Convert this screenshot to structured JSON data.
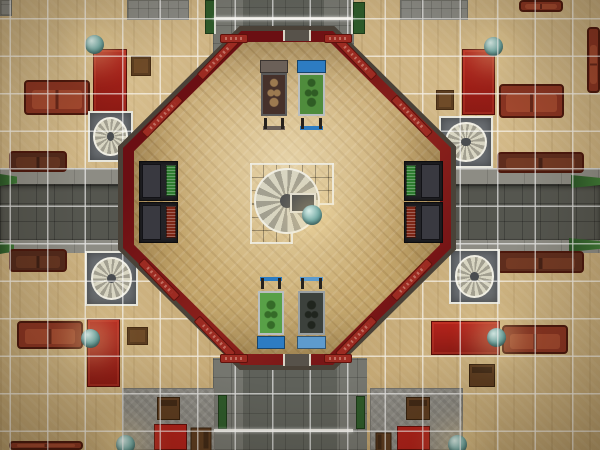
{
  "scene": {
    "view": "top-down-floorplan",
    "environment": "octagonal game room surrounded by tiled plaza with streets",
    "grid_spacing_px": 37.5,
    "colors": {
      "plaza_tile_tan": "#c9ae7d",
      "grid_line": "#ffffff",
      "street_dark": "#55564f",
      "sidewalk_gray": "#8d8c84",
      "wall_red": "#7a1216",
      "wall_panel_red": "#9c2b22",
      "roof_edge_brown": "#4a4238",
      "parquet_floor": "#cfb27c",
      "platform_slate": "#43474b",
      "railing_white": "#f0eee2",
      "sofa_red": "#8a3422",
      "sofa_dark_brown": "#5f2d1d",
      "bookcase_red": "#a8201a",
      "lamp_globe_teal": "#74aba5",
      "pinball_blue": "#2d7cc2",
      "pinball_green": "#4f8c3c",
      "planter_green": "#2e5a2a"
    }
  },
  "objects": [
    {
      "type": "concrete-patch",
      "name": "concrete-corner-northwest",
      "layer": "ext",
      "interactable": false,
      "x": 0,
      "y": 0,
      "w": 12,
      "h": 16
    },
    {
      "type": "concrete-patch",
      "name": "concrete-patch-north-left",
      "layer": "ext",
      "interactable": false,
      "x": 127,
      "y": 0,
      "w": 62,
      "h": 20
    },
    {
      "type": "concrete-patch",
      "name": "concrete-patch-north-right",
      "layer": "ext",
      "interactable": false,
      "x": 400,
      "y": 0,
      "w": 68,
      "h": 20
    },
    {
      "type": "patio",
      "name": "stone-patio-southwest",
      "layer": "ext",
      "interactable": false,
      "x": 122,
      "y": 388,
      "w": 93,
      "h": 62
    },
    {
      "type": "patio",
      "name": "stone-patio-southeast",
      "layer": "ext",
      "interactable": false,
      "x": 370,
      "y": 388,
      "w": 93,
      "h": 62
    },
    {
      "type": "green-wedge",
      "name": "hedge-west-upper",
      "layer": "ext",
      "x": 0,
      "y": 174,
      "w": 17,
      "h": 12
    },
    {
      "type": "green-wedge",
      "name": "hedge-west-lower",
      "layer": "ext",
      "x": 0,
      "y": 242,
      "w": 14,
      "h": 12
    },
    {
      "type": "green-wedge",
      "name": "hedge-east-upper",
      "layer": "ext",
      "x": 571,
      "y": 175,
      "w": 29,
      "h": 13
    },
    {
      "type": "green-wedge",
      "name": "hedge-east-lower",
      "layer": "ext",
      "x": 569,
      "y": 238,
      "w": 31,
      "h": 14
    },
    {
      "type": "planter",
      "name": "planter-north-left",
      "layer": "ext",
      "x": 205,
      "y": 0,
      "w": 11,
      "h": 34
    },
    {
      "type": "planter",
      "name": "planter-north-right",
      "layer": "ext",
      "x": 353,
      "y": 2,
      "w": 12,
      "h": 32
    },
    {
      "type": "planter",
      "name": "planter-south-left",
      "layer": "ext",
      "x": 218,
      "y": 395,
      "w": 9,
      "h": 34
    },
    {
      "type": "planter",
      "name": "planter-south-right",
      "layer": "ext",
      "x": 356,
      "y": 396,
      "w": 9,
      "h": 33
    },
    {
      "type": "path-rail",
      "name": "fence-north-left",
      "layer": "ext",
      "interactable": false,
      "x": 214,
      "y": 0,
      "w": 2,
      "h": 34
    },
    {
      "type": "path-rail",
      "name": "fence-north-right",
      "layer": "ext",
      "interactable": false,
      "x": 351,
      "y": 0,
      "w": 2,
      "h": 34
    },
    {
      "type": "couch",
      "name": "sofa-west-upper",
      "layer": "ext",
      "x": 9,
      "y": 151,
      "w": 58,
      "h": 21,
      "vars": {
        "--cc": "#52291b",
        "--cs": "#653521"
      }
    },
    {
      "type": "couch",
      "name": "sofa-west-lower",
      "layer": "ext",
      "x": 9,
      "y": 249,
      "w": 58,
      "h": 23,
      "vars": {
        "--cc": "#52291b",
        "--cs": "#653521"
      }
    },
    {
      "type": "couch",
      "name": "sofa-east-upper",
      "layer": "ext",
      "x": 497,
      "y": 152,
      "w": 87,
      "h": 21,
      "vars": {
        "--cc": "#5f2d1d",
        "--cs": "#743a24"
      }
    },
    {
      "type": "couch",
      "name": "sofa-east-lower",
      "layer": "ext",
      "x": 497,
      "y": 251,
      "w": 87,
      "h": 22,
      "vars": {
        "--cc": "#5f2d1d",
        "--cs": "#743a24"
      }
    },
    {
      "type": "couch",
      "name": "sofa-northwest",
      "layer": "ext",
      "x": 24,
      "y": 80,
      "w": 66,
      "h": 35
    },
    {
      "type": "couch",
      "name": "sofa-northeast",
      "layer": "ext",
      "x": 499,
      "y": 84,
      "w": 65,
      "h": 34
    },
    {
      "type": "couch",
      "name": "sofa-southwest",
      "layer": "ext",
      "x": 17,
      "y": 321,
      "w": 66,
      "h": 28
    },
    {
      "type": "couch",
      "name": "sofa-southeast",
      "layer": "ext",
      "x": 502,
      "y": 325,
      "w": 66,
      "h": 29
    },
    {
      "type": "couch",
      "name": "sofa-north-edge",
      "layer": "ext",
      "x": 519,
      "y": 0,
      "w": 44,
      "h": 12
    },
    {
      "type": "couch",
      "name": "sofa-east-edge",
      "cls": "v",
      "layer": "ext",
      "x": 587,
      "y": 27,
      "w": 13,
      "h": 66
    },
    {
      "type": "couch",
      "name": "sofa-south-edge",
      "layer": "ext",
      "x": 9,
      "y": 441,
      "w": 74,
      "h": 9
    },
    {
      "type": "bookshelf",
      "name": "bookcase-northwest",
      "layer": "ext",
      "x": 93,
      "y": 49,
      "w": 34,
      "h": 64
    },
    {
      "type": "bookshelf",
      "name": "bookcase-northeast",
      "layer": "ext",
      "x": 462,
      "y": 49,
      "w": 33,
      "h": 66
    },
    {
      "type": "bookshelf",
      "name": "bookcase-southwest",
      "layer": "ext",
      "x": 87,
      "y": 319,
      "w": 33,
      "h": 68
    },
    {
      "type": "bookshelf",
      "name": "bookcase-southeast",
      "layer": "ext",
      "x": 431,
      "y": 321,
      "w": 69,
      "h": 34
    },
    {
      "type": "end-table",
      "name": "end-table-northwest",
      "layer": "ext",
      "x": 131,
      "y": 56,
      "w": 20,
      "h": 20
    },
    {
      "type": "end-table",
      "name": "end-table-northeast",
      "layer": "ext",
      "x": 436,
      "y": 90,
      "w": 18,
      "h": 20
    },
    {
      "type": "end-table",
      "name": "end-table-southwest",
      "layer": "ext",
      "x": 127,
      "y": 327,
      "w": 21,
      "h": 18
    },
    {
      "type": "chair",
      "name": "chair-southeast",
      "layer": "ext",
      "x": 469,
      "y": 364,
      "w": 26,
      "h": 23
    },
    {
      "type": "chair",
      "name": "patio-chair-southwest-a",
      "layer": "ext",
      "x": 157,
      "y": 397,
      "w": 23,
      "h": 23
    },
    {
      "type": "red-table",
      "name": "patio-table-southwest",
      "layer": "ext",
      "x": 154,
      "y": 424,
      "w": 33,
      "h": 26
    },
    {
      "type": "chair",
      "name": "patio-chair-southwest-b",
      "layer": "ext",
      "rot": 90,
      "x": 189,
      "y": 429,
      "w": 24,
      "h": 21
    },
    {
      "type": "chair",
      "name": "patio-chair-southeast-a",
      "layer": "ext",
      "x": 406,
      "y": 397,
      "w": 24,
      "h": 23
    },
    {
      "type": "red-table",
      "name": "patio-table-southeast",
      "layer": "ext",
      "x": 397,
      "y": 426,
      "w": 33,
      "h": 24
    },
    {
      "type": "chair",
      "name": "patio-chair-southeast-b",
      "layer": "ext",
      "rot": -90,
      "x": 374,
      "y": 434,
      "w": 19,
      "h": 16
    },
    {
      "type": "spiral-stairs",
      "name": "spiral-staircase-northwest",
      "layer": "ext",
      "x": 88,
      "y": 111,
      "w": 45,
      "h": 51
    },
    {
      "type": "spiral-stairs",
      "name": "spiral-staircase-northeast",
      "layer": "ext",
      "x": 439,
      "y": 116,
      "w": 54,
      "h": 52
    },
    {
      "type": "spiral-stairs",
      "name": "spiral-staircase-southwest",
      "layer": "ext",
      "x": 85,
      "y": 251,
      "w": 53,
      "h": 55
    },
    {
      "type": "spiral-stairs",
      "name": "spiral-staircase-southeast",
      "layer": "ext",
      "x": 449,
      "y": 249,
      "w": 51,
      "h": 55
    },
    {
      "type": "gate",
      "name": "gate-north",
      "layer": "ext",
      "x": 214,
      "y": 17,
      "w": 139,
      "h": 3
    },
    {
      "type": "gate",
      "name": "gate-south",
      "layer": "ext",
      "x": 214,
      "y": 429,
      "w": 139,
      "h": 3
    },
    {
      "type": "globe-lamp",
      "name": "lamp-northwest",
      "layer": "ext",
      "x": 85,
      "y": 35,
      "w": 19,
      "h": 19
    },
    {
      "type": "globe-lamp",
      "name": "lamp-northeast",
      "layer": "ext",
      "x": 484,
      "y": 37,
      "w": 19,
      "h": 19
    },
    {
      "type": "globe-lamp",
      "name": "lamp-southwest",
      "layer": "ext",
      "x": 81,
      "y": 329,
      "w": 19,
      "h": 19
    },
    {
      "type": "globe-lamp",
      "name": "lamp-southeast",
      "layer": "ext",
      "x": 487,
      "y": 328,
      "w": 19,
      "h": 19
    },
    {
      "type": "globe-lamp",
      "name": "lamp-patio-southwest",
      "layer": "ext",
      "x": 116,
      "y": 435,
      "w": 19,
      "h": 19
    },
    {
      "type": "globe-lamp",
      "name": "lamp-patio-southeast",
      "layer": "ext",
      "x": 448,
      "y": 435,
      "w": 19,
      "h": 19
    },
    {
      "type": "arcade-cabinet",
      "name": "arcade-cabinet-west-upper",
      "cls": "face-r",
      "layer": "int",
      "x": 139,
      "y": 161,
      "w": 39,
      "h": 40,
      "vars": {
        "--sc": "#2e7c30"
      }
    },
    {
      "type": "arcade-cabinet",
      "name": "arcade-cabinet-west-lower",
      "cls": "face-r",
      "layer": "int",
      "x": 139,
      "y": 202,
      "w": 39,
      "h": 41,
      "vars": {
        "--sc": "#7c2616"
      }
    },
    {
      "type": "arcade-cabinet",
      "name": "arcade-cabinet-east-upper",
      "cls": "face-l",
      "layer": "int",
      "x": 404,
      "y": 161,
      "w": 39,
      "h": 40,
      "vars": {
        "--sc": "#2e7c30"
      }
    },
    {
      "type": "arcade-cabinet",
      "name": "arcade-cabinet-east-lower",
      "cls": "face-l",
      "layer": "int",
      "x": 404,
      "y": 202,
      "w": 39,
      "h": 41,
      "vars": {
        "--sc": "#7c2616"
      }
    },
    {
      "type": "pinball",
      "name": "pinball-machine-top-left",
      "layer": "int",
      "x": 259,
      "y": 60,
      "w": 30,
      "h": 70,
      "vars": {
        "--head": "#6b6058",
        "--field": "#46312a",
        "--art": "#9c7a50",
        "--fr": "#5a5a5a"
      }
    },
    {
      "type": "pinball",
      "name": "pinball-machine-top-right",
      "layer": "int",
      "x": 296,
      "y": 60,
      "w": 31,
      "h": 70,
      "vars": {
        "--head": "#2d7cc2",
        "--field": "#4f8c3c",
        "--art": "#2f5c24",
        "--fr": "#b9bec0"
      }
    },
    {
      "type": "pinball",
      "name": "pinball-machine-bottom-left",
      "layer": "int",
      "rot": 180,
      "x": 256,
      "y": 277,
      "w": 30,
      "h": 72,
      "vars": {
        "--head": "#2d7cc2",
        "--field": "#58a047",
        "--art": "#356b28",
        "--fr": "#b9bec0"
      }
    },
    {
      "type": "pinball",
      "name": "pinball-machine-bottom-right",
      "layer": "int",
      "rot": 180,
      "x": 296,
      "y": 277,
      "w": 31,
      "h": 72,
      "vars": {
        "--head": "#5e9bcd",
        "--field": "#3c413c",
        "--art": "#20251e",
        "--fr": "#9aa0a2"
      }
    },
    {
      "type": "globe-lamp",
      "name": "plant-center-platform",
      "layer": "int",
      "x": 302,
      "y": 205,
      "w": 20,
      "h": 20
    }
  ]
}
